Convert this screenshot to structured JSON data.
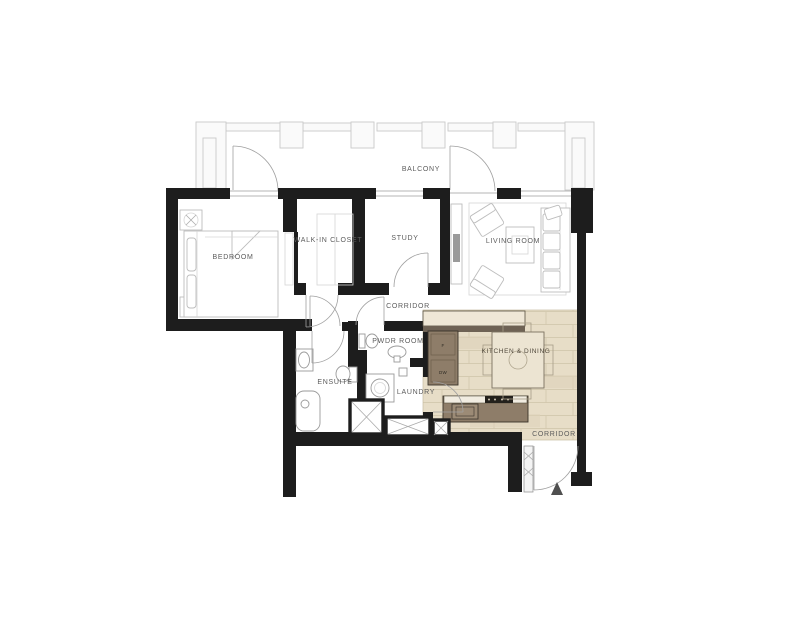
{
  "floorplan": {
    "rooms": {
      "balcony": "BALCONY",
      "bedroom": "BEDROOM",
      "walk_in_closet": "WALK-IN CLOSET",
      "study": "STUDY",
      "living_room": "LIVING ROOM",
      "corridor": "CORRIDOR",
      "pwdr_room": "PWDR ROOM",
      "ensuite": "ENSUITE",
      "laundry": "LAUNDRY",
      "kitchen_dining": "KITCHEN & DINING",
      "entry_corridor": "CORRIDOR"
    },
    "appliances": {
      "fridge": "F",
      "dishwasher": "DW"
    },
    "colors": {
      "wall": "#1d1d1d",
      "wood_floor": "#e7ddc7",
      "counter": "#8e7d69",
      "label": "#5c5c5c",
      "balcony_line": "#c9c9c9"
    }
  }
}
